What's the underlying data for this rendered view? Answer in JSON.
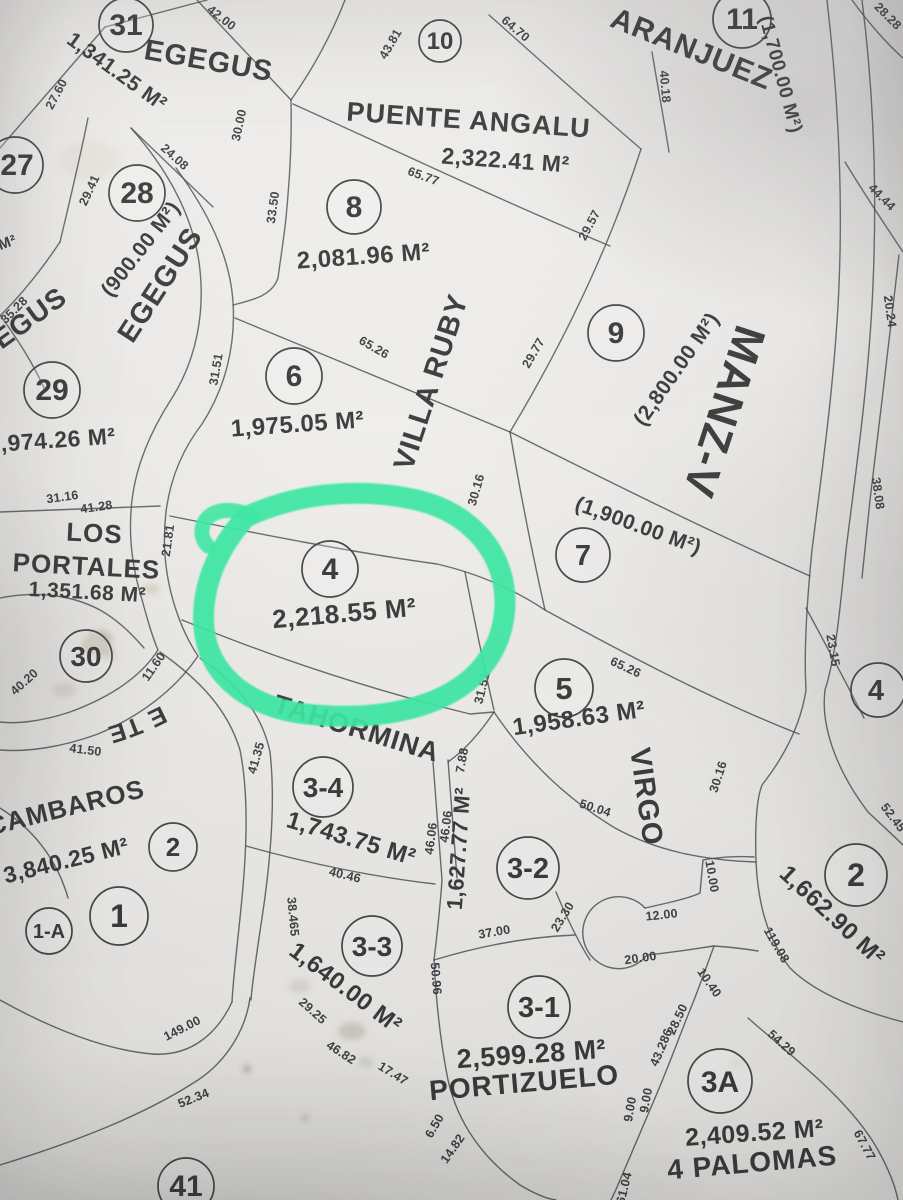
{
  "document": {
    "type": "cadastral-plot-map-photo"
  },
  "highlight": {
    "lot": "4",
    "color": "#3BE9A4"
  },
  "block_label": "MANZ-V",
  "streets": {
    "egegus": "EGEGUS",
    "calle": "CALLE TE",
    "villa_ruby": "VILLA RUBY",
    "virgo": "VIRGO"
  },
  "lots": [
    {
      "number": "31",
      "name": "EGEGUS",
      "area": "1,341.25 M²"
    },
    {
      "number": "10",
      "name": "PUENTE ANGALU",
      "area": "2,322.41 M²"
    },
    {
      "number": "11",
      "name": "ARANJUEZ",
      "area": "(1,700.00 M²)"
    },
    {
      "number": "27",
      "area_fragment": "M²"
    },
    {
      "number": "28",
      "area": "(900.00 M²)"
    },
    {
      "number": "8",
      "area": "2,081.96 M²"
    },
    {
      "number": "29",
      "name": "EGEGUS",
      "area": "1,974.26 M²"
    },
    {
      "number": "6",
      "area": "1,975.05 M²"
    },
    {
      "number": "9",
      "area": "(2,800.00 M²)"
    },
    {
      "number": "7",
      "area": "(1,900.00 M²)"
    },
    {
      "number": "4",
      "area": "2,218.55 M²",
      "highlighted": true
    },
    {
      "number": "30",
      "name_line1": "LOS",
      "name_line2": "PORTALES",
      "area": "1,351.68 M²"
    },
    {
      "number": "5",
      "area": "1,958.63 M²"
    },
    {
      "number": "4"
    },
    {
      "number": "3-4",
      "name": "TAHORMINA",
      "area": "1,743.75 M²"
    },
    {
      "number": "2",
      "name": "CAMBAROS",
      "area": "3,840.25 M²"
    },
    {
      "number": "1"
    },
    {
      "number": "1-A"
    },
    {
      "number": "3-2",
      "area": "1,627.77 M²"
    },
    {
      "number": "2",
      "area": "1,662.90 M²"
    },
    {
      "number": "3-3",
      "area": "1,640.00 M²"
    },
    {
      "number": "3-1",
      "name": "PORTIZUELO",
      "area": "2,599.28 M²"
    },
    {
      "number": "3A",
      "name": "4 PALOMAS",
      "area": "2,409.52 M²"
    },
    {
      "number": "41"
    }
  ],
  "dims": [
    "42.00",
    "43.81",
    "27.60",
    "29.41",
    "24.08",
    "30.00",
    "33.50",
    "65.77",
    "64.70",
    "40.18",
    "28.28",
    "44.44",
    "29.57",
    "29.77",
    "20.24",
    "38.08",
    "31.51",
    "65.26",
    "30.16",
    "35.28",
    "31.16",
    "41.28",
    "21.81",
    "30.16",
    "23.15",
    "40.20",
    "11.60",
    "41.50",
    "65.26",
    "31.51",
    "50.04",
    "41.35",
    "7.88",
    "46.06",
    "46.06",
    "40.46",
    "38.465",
    "52.45",
    "119.08",
    "149.00",
    "52.34",
    "29.25",
    "46.82",
    "17.47",
    "50.96",
    "37.00",
    "12.00",
    "10.00",
    "20.00",
    "23.30",
    "10.40",
    "28.50",
    "43.286",
    "9.00",
    "9.00",
    "61.04",
    "54.29",
    "67.77",
    "6.50",
    "14.82"
  ]
}
